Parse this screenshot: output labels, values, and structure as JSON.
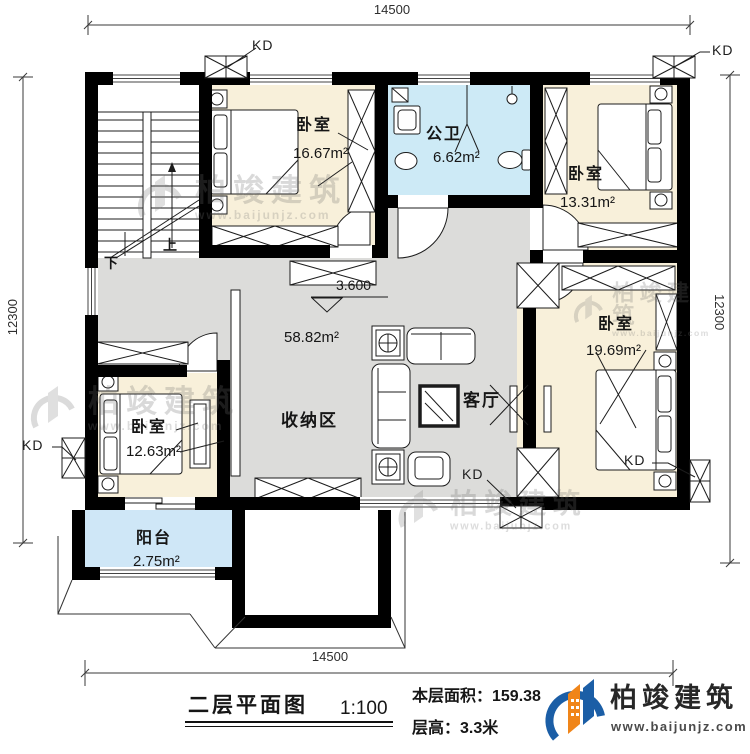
{
  "colors": {
    "bedroom_fill": "#f8f0da",
    "bath_fill": "#cdeaf6",
    "balcony_fill": "#cfe7f7",
    "hall_fill": "#dcdcda",
    "wall": "#000000",
    "logo_blue": "#1b5ea6",
    "logo_orange": "#f08519"
  },
  "dimensions": {
    "top": "14500",
    "bottom": "14500",
    "left": "12300",
    "right": "12300"
  },
  "window_label": "KD",
  "level_label": "3.600",
  "stairs": {
    "up": "上",
    "down": "下"
  },
  "rooms": {
    "bedroom_top_left": {
      "name": "卧室",
      "area": "16.67m²"
    },
    "bathroom": {
      "name": "公卫",
      "area": "6.62m²"
    },
    "bedroom_top_right": {
      "name": "卧室",
      "area": "13.31m²"
    },
    "bedroom_right": {
      "name": "卧室",
      "area": "19.69m²"
    },
    "bedroom_bottom_left": {
      "name": "卧室",
      "area": "12.63m²"
    },
    "balcony": {
      "name": "阳台",
      "area": "2.75m²"
    },
    "hall": {
      "area": "58.82m²",
      "storage_label": "收纳区",
      "living_label": "客厅"
    }
  },
  "title_block": {
    "plan_title": "二层平面图",
    "scale": "1:100",
    "floor_area": "本层面积：159.38",
    "floor_height": "层高：3.3米",
    "brand": "柏竣建筑",
    "website": "www.baijunjz.com"
  },
  "watermark": {
    "brand": "柏竣建筑",
    "website": "www.baijunjz.com"
  }
}
